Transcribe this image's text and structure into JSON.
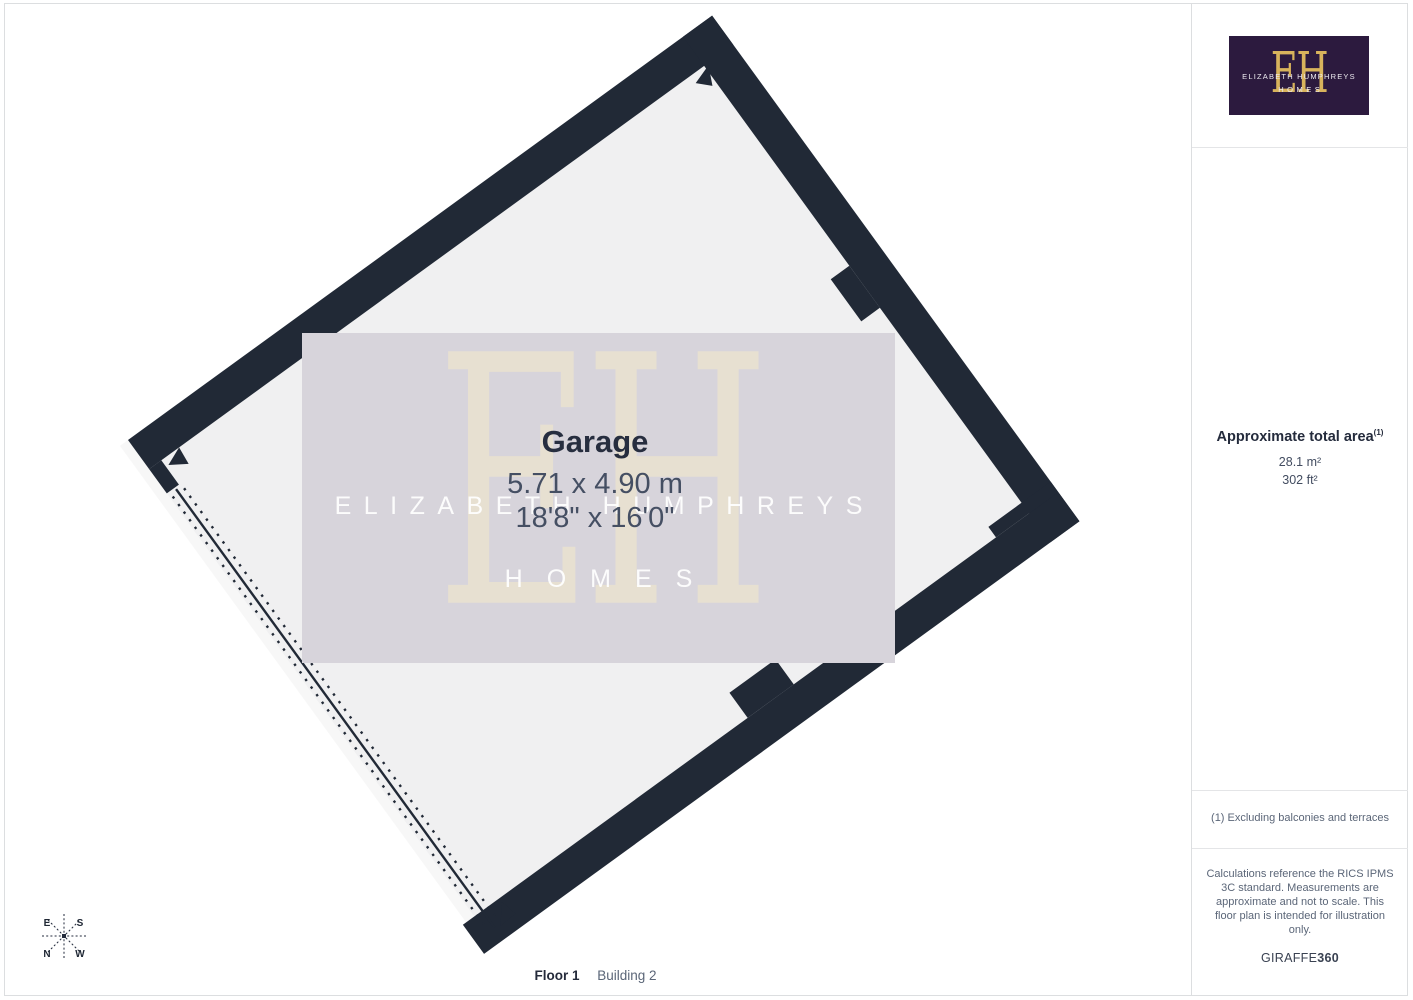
{
  "plan": {
    "room": {
      "name": "Garage",
      "dims_metric": "5.71 x 4.90 m",
      "dims_imperial": "18'8\" x 16'0\""
    },
    "watermark": {
      "monogram": "EH",
      "line1": "ELIZABETH HUMPHREYS",
      "line2": "HOMES"
    },
    "compass": {
      "e": "E",
      "s": "S",
      "n": "N",
      "w": "W"
    },
    "footer": {
      "floor": "Floor 1",
      "building": "Building 2"
    }
  },
  "sidebar": {
    "logo": {
      "monogram": "EH",
      "line1": "ELIZABETH HUMPHREYS",
      "line2": "HOMES"
    },
    "area": {
      "title": "Approximate total area",
      "footnote_ref": "(1)",
      "metric": "28.1 m²",
      "imperial": "302 ft²"
    },
    "footnote": "(1) Excluding balconies and terraces",
    "disclaimer": "Calculations reference the RICS IPMS 3C standard. Measurements are approximate and not to scale. This floor plan is intended for illustration only.",
    "provider": {
      "brand": "GIRAFFE",
      "suffix": "360"
    }
  },
  "colors": {
    "wall": "#212936",
    "floor": "#f0f0f1",
    "watermark_box": "#d7d4db",
    "logo_bg": "#2c1a3e",
    "gold": "#d8b35c",
    "heading_text": "#242b3c",
    "body_text": "#5b6678"
  }
}
